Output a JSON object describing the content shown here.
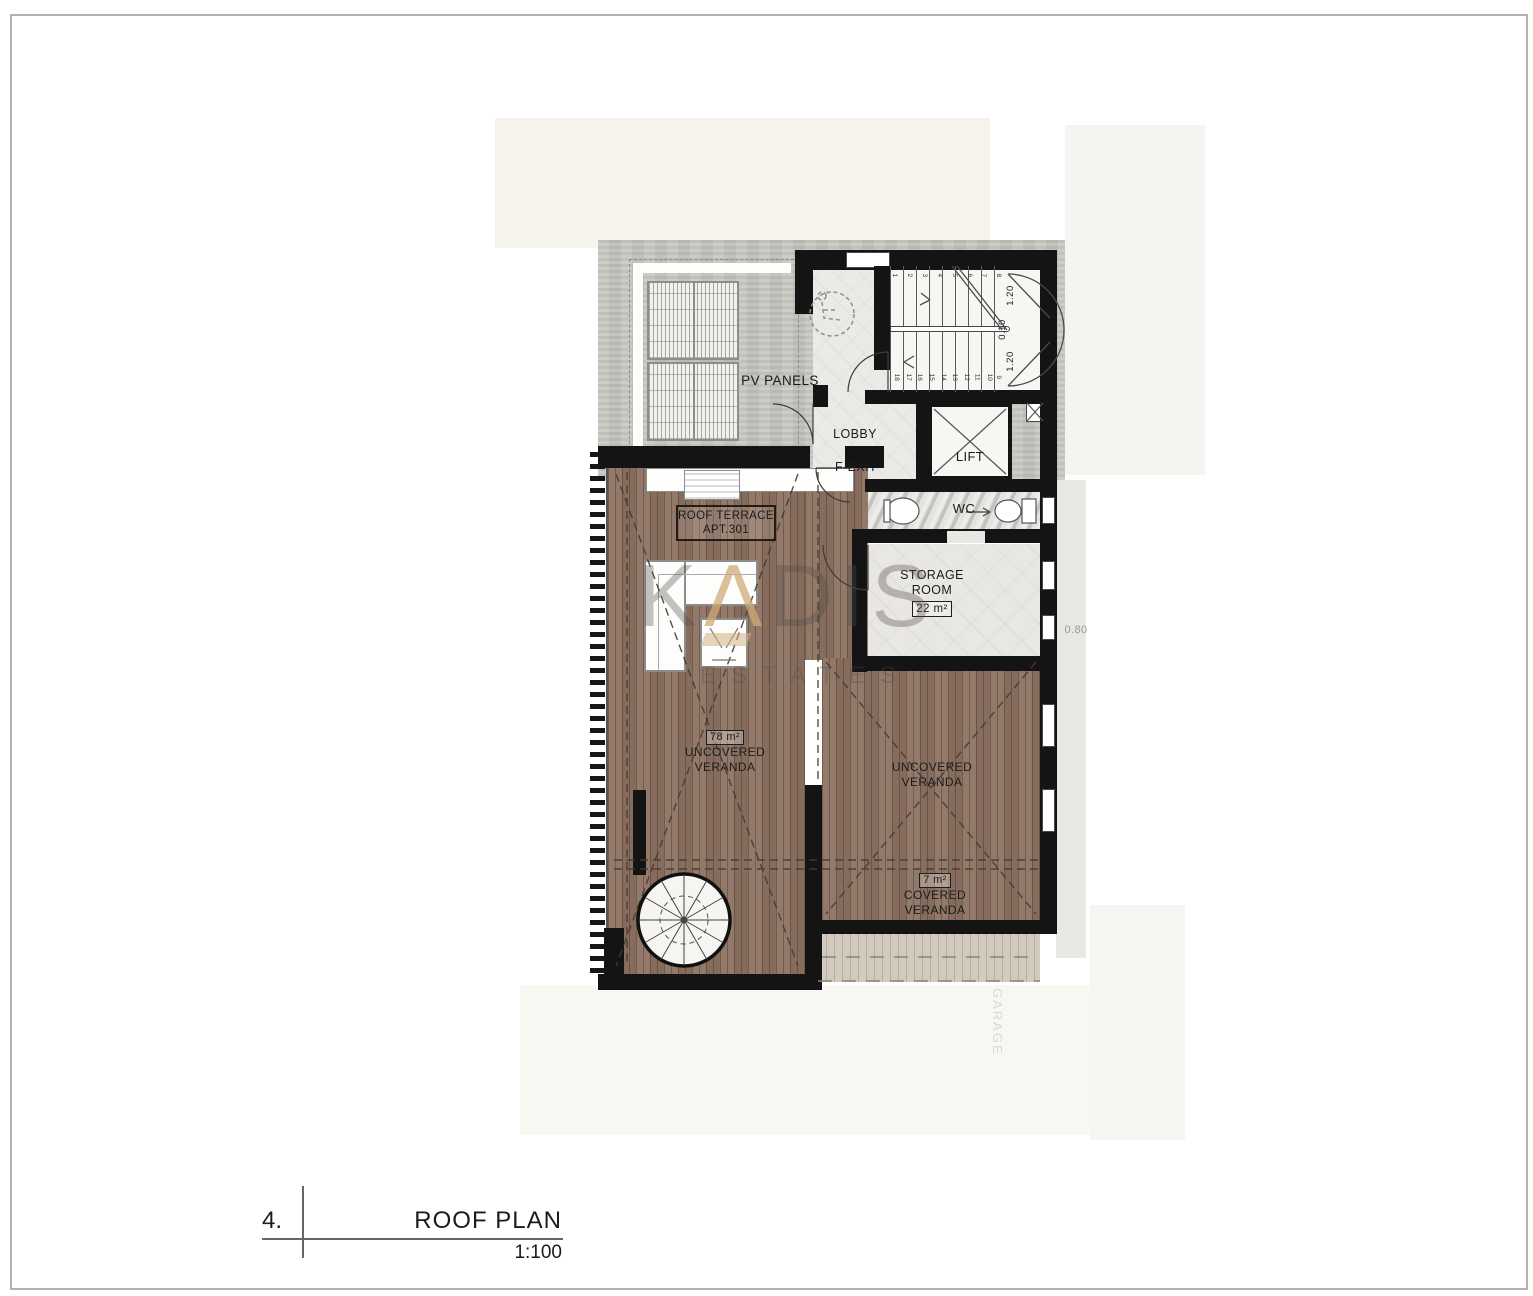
{
  "page": {
    "sheet_number": "4.",
    "title": "ROOF PLAN",
    "scale": "1:100"
  },
  "labels": {
    "pv_panels": "PV PANELS",
    "lobby": "LOBBY",
    "f_exit": "F-EXIT",
    "lift": "LIFT",
    "wc": "WC",
    "storage_line1": "STORAGE",
    "storage_line2": "ROOM",
    "storage_area": "22 m²",
    "roof_terrace": "ROOF TERRACE",
    "roof_terrace_apt": "APT.301",
    "veranda_left_area": "78 m²",
    "uncovered_line1": "UNCOVERED",
    "uncovered_line2": "VERANDA",
    "covered_area": "7 m²",
    "covered_line1": "COVERED",
    "covered_line2": "VERANDA"
  },
  "dimensions": {
    "stair_width_top": "1.20",
    "stair_gap": "0.10",
    "stair_width_bottom": "1.20",
    "side_offset": "0.80"
  },
  "stairs": {
    "top_run": [
      "1",
      "2",
      "3",
      "4",
      "5",
      "6",
      "7",
      "8"
    ],
    "bottom_run": [
      "18",
      "17",
      "16",
      "15",
      "14",
      "13",
      "12",
      "11",
      "10",
      "9"
    ]
  },
  "watermark": {
    "l1": "K",
    "l2": "Λ",
    "l3": "D",
    "l4": "I",
    "l5": "S",
    "subtitle": "ESTATES"
  },
  "ghost": {
    "garage": "GARAGE"
  },
  "colors": {
    "wood": "#8d7262",
    "wood_light": "#d2cabd",
    "concrete": "#c7c5bf",
    "wall": "#141414",
    "tile": "#e8e7e3",
    "accent_gold": "#cfa977"
  }
}
